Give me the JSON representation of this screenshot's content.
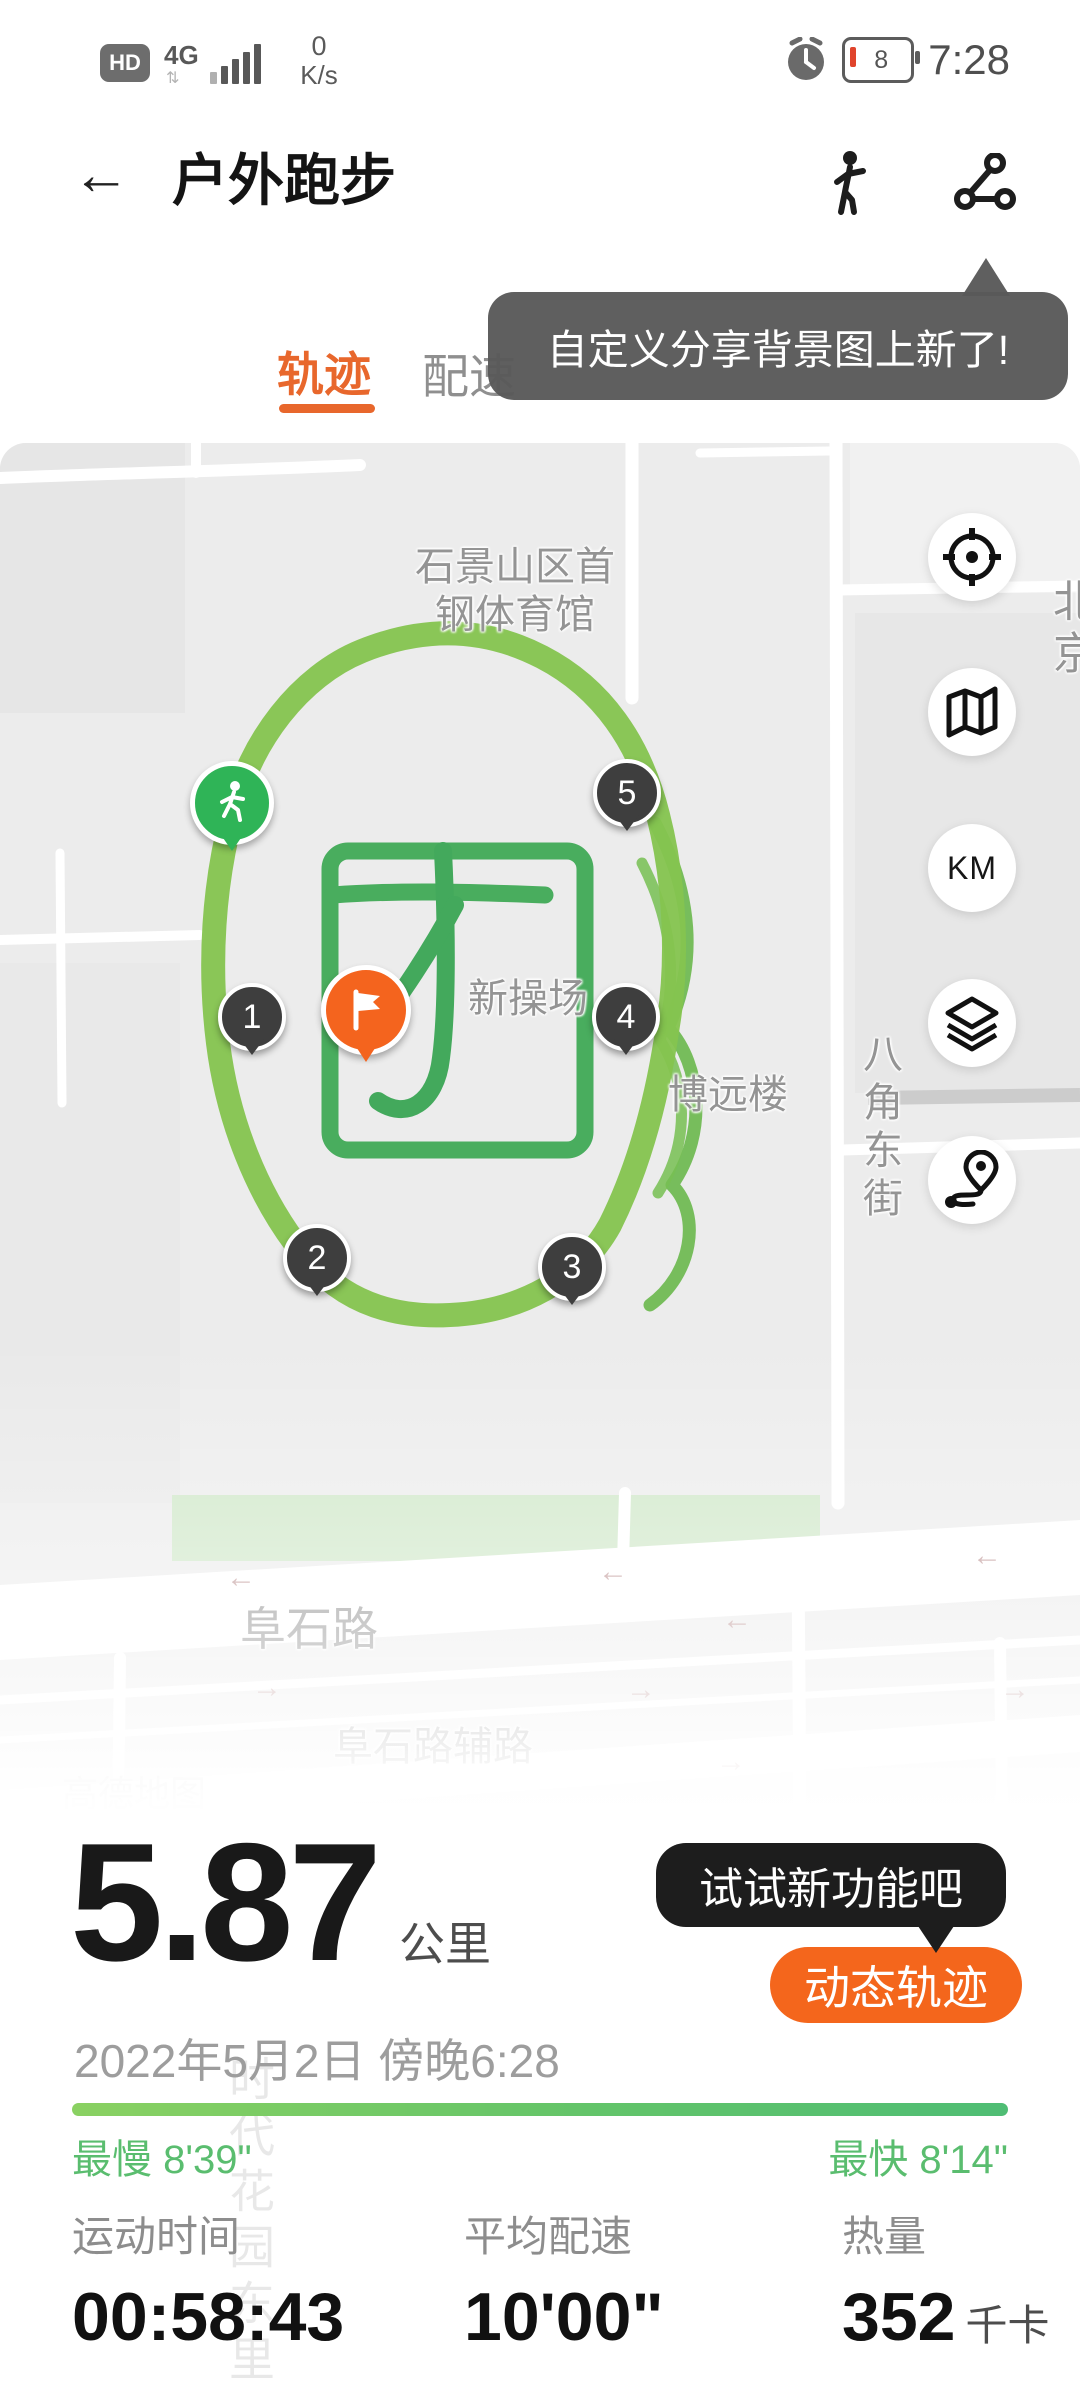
{
  "status_bar": {
    "hd": "HD",
    "network": "4G",
    "net_arrows": "⇅",
    "speed_value": "0",
    "speed_unit": "K/s",
    "battery_level": "8",
    "time": "7:28"
  },
  "header": {
    "title": "户外跑步"
  },
  "promo_tooltip": {
    "text": "自定义分享背景图上新了!"
  },
  "tabs": [
    {
      "label": "轨迹",
      "active": true
    },
    {
      "label": "配速",
      "active": false
    }
  ],
  "map": {
    "labels": {
      "stadium_line1": "石景山区首",
      "stadium_line2": "钢体育馆",
      "playground": "新操场",
      "building": "博远楼",
      "street_vertical": "八角东街",
      "north_clipped": "北京",
      "road_main": "阜石路",
      "road_side": "阜石路辅路",
      "attribution": "高德地图"
    },
    "arrow_left": "←",
    "arrow_right": "→",
    "buttons": {
      "km_label": "KM"
    },
    "markers": {
      "km": [
        "1",
        "2",
        "3",
        "4",
        "5"
      ]
    }
  },
  "feature_tooltip": {
    "text": "试试新功能吧"
  },
  "dynamic_track_button": {
    "label": "动态轨迹"
  },
  "summary": {
    "distance": "5.87",
    "distance_unit": "公里",
    "date": "2022年5月2日 傍晚6:28",
    "slowest": "最慢 8'39\"",
    "fastest": "最快 8'14\""
  },
  "stats": [
    {
      "label": "运动时间",
      "value": "00:58:43",
      "unit": ""
    },
    {
      "label": "平均配速",
      "value": "10'00\"",
      "unit": ""
    },
    {
      "label": "热量",
      "value": "352",
      "unit": "千卡"
    }
  ],
  "watermark_faint": "时代花园东里",
  "colors": {
    "accent_orange": "#e8672c",
    "button_orange": "#f4661c",
    "track_green": "#85c44f",
    "art_green": "#49ad5e",
    "pace_green": "#5abd6f"
  }
}
